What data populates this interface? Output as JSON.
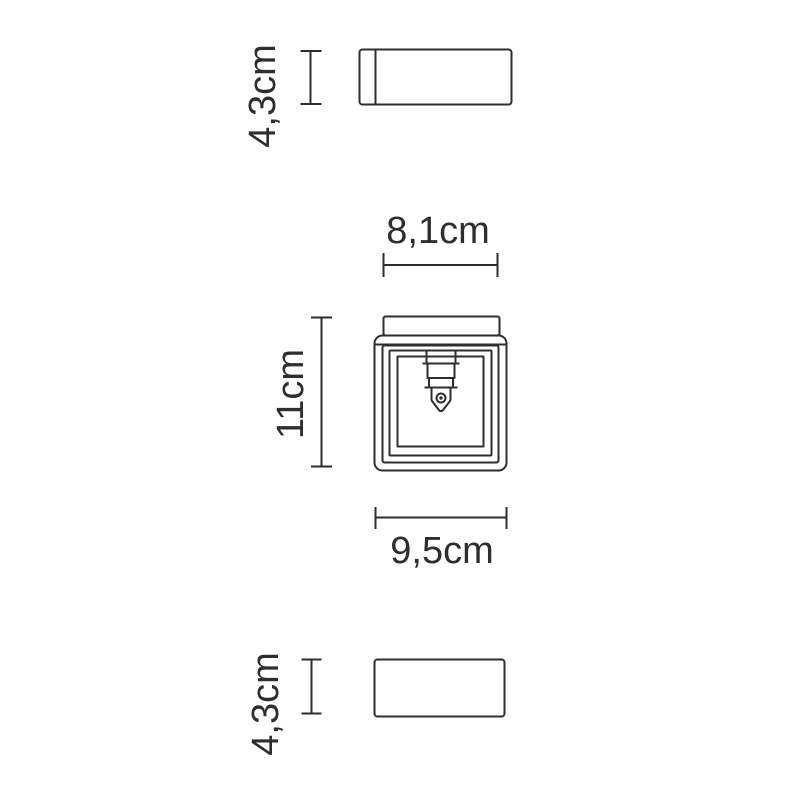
{
  "page": {
    "background_color": "#ffffff",
    "line_color": "#2e2e2e",
    "text_color": "#2e2e2e"
  },
  "drawing": {
    "labels": {
      "top_view_height": "4,3cm",
      "front_view_top_width": "8,1cm",
      "front_view_height": "11cm",
      "front_view_bottom_width": "9,5cm",
      "bottom_view_height": "4,3cm"
    }
  }
}
